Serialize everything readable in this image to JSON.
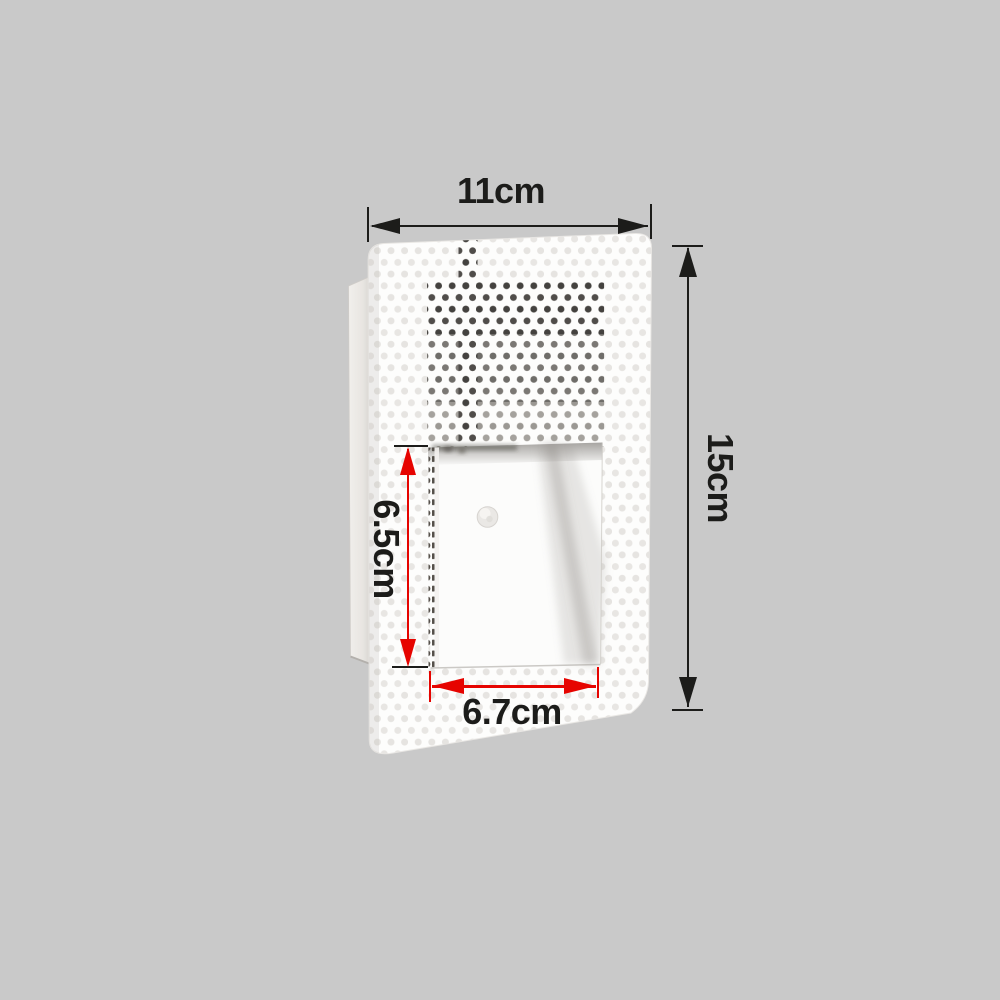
{
  "scene": {
    "background_color": "#c9c9c9",
    "description": "Recessed step wall light product photo annotated with dimensions"
  },
  "product": {
    "name": "recessed-step-wall-light",
    "faceplate_color": "#fdfdfc",
    "perforation_light_color": "#e8e6e3",
    "perforation_dark_color": "#44423f",
    "visible_parts": [
      "perforated faceplate",
      "mounting box side",
      "recessed light opening",
      "sensor dot"
    ]
  },
  "dimensions": {
    "overall_width": {
      "label": "11cm",
      "line_color": "#1c1c1a",
      "text_color": "#1c1c1a"
    },
    "overall_height": {
      "label": "15cm",
      "line_color": "#1c1c1a",
      "text_color": "#1c1c1a"
    },
    "opening_height": {
      "label": "6.5cm",
      "line_color": "#e60400",
      "text_color": "#1c1c1a"
    },
    "opening_width": {
      "label": "6.7cm",
      "line_color": "#e60400",
      "text_color": "#1c1c1a"
    }
  }
}
